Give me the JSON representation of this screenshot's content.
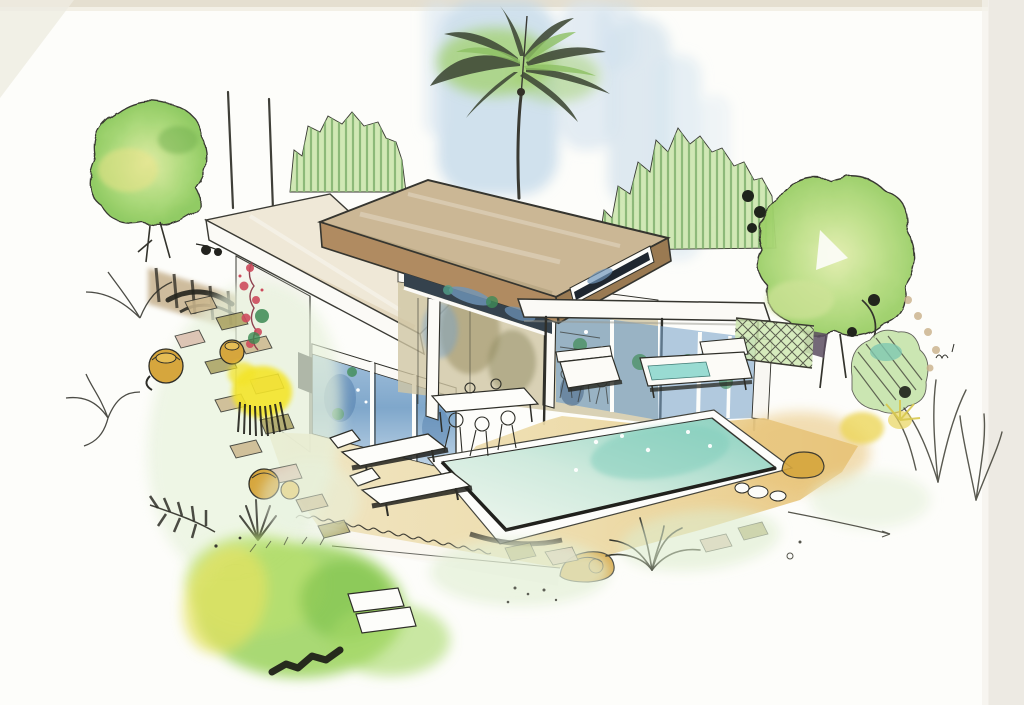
{
  "artwork": {
    "type": "watercolor-architectural-sketch",
    "subject": "modern flat-roof villa with covered terrace, wooden deck, swimming pool, palm tree and tropical garden",
    "style": "loose ink line drawing with watercolor washes on white paper",
    "view": "aerial front-left perspective"
  },
  "palette": {
    "paper": "#fdfdfa",
    "paper_edge": "#e6dfcf",
    "paper_edge_soft": "#ece9e0",
    "ink": "#2e2e28",
    "sky": "#c3d8e9",
    "sky_light": "#d7e4f0",
    "palm_green": "#a2d06c",
    "frond_dark": "#414b38",
    "roof_tan": "#cbb795",
    "fascia_brown": "#b08b61",
    "fascia_brown_dark": "#9a7a52",
    "roof_cream": "#efe8d7",
    "wall_white": "#fbfaf6",
    "glass_blue": "#7fa7cb",
    "glass_blue_deep": "#5480ae",
    "glass_green": "#3e8c55",
    "interior_olive": "#cfc5a4",
    "deck_sand": "#efe3bd",
    "deck_gold": "#e8c377",
    "pool_deep": "#87cfbe",
    "pool_mid": "#cfeadd",
    "pool_pale": "#f0f7ef",
    "lawn_green": "#9ad25c",
    "lawn_light": "#b8e070",
    "lawn_pale": "#e2f0d6",
    "grass_yellow": "#e6e261",
    "bright_yellow": "#f3e42c",
    "tree_green": "#8cc95c",
    "tree_green_light": "#bcdf86",
    "hedge_fill": "#cfe7b2",
    "hedge_stripe": "#86b473",
    "fence_tan": "#c2ac86",
    "ochre": "#d6a63d",
    "flower_red": "#cd4b5c",
    "stone_tan": "#cbb68d",
    "stone_olive": "#a8a05f",
    "stone_pink": "#d9bcab",
    "teal_accent": "#8fd8cf",
    "dark_purple": "#5c4e60"
  },
  "scene": {
    "elements": [
      "sky-wash",
      "palm-tree",
      "striped-hedge-left",
      "striped-hedge-right",
      "left-tree",
      "right-tree",
      "garden-fence",
      "main-roof",
      "left-roof",
      "clerestory-window",
      "glass-doors-left",
      "center-interior",
      "veranda-canopy",
      "glass-wall-right",
      "trellis-fence",
      "deck",
      "pool",
      "sun-loungers",
      "dining-set",
      "sofa-set",
      "stepping-stones",
      "clay-pots",
      "yellow-bush",
      "red-climber",
      "ferns",
      "agave-plant",
      "grasses-right",
      "lawn-bush",
      "lawn-wash",
      "deck-steps",
      "rocks",
      "sketch-line"
    ]
  }
}
